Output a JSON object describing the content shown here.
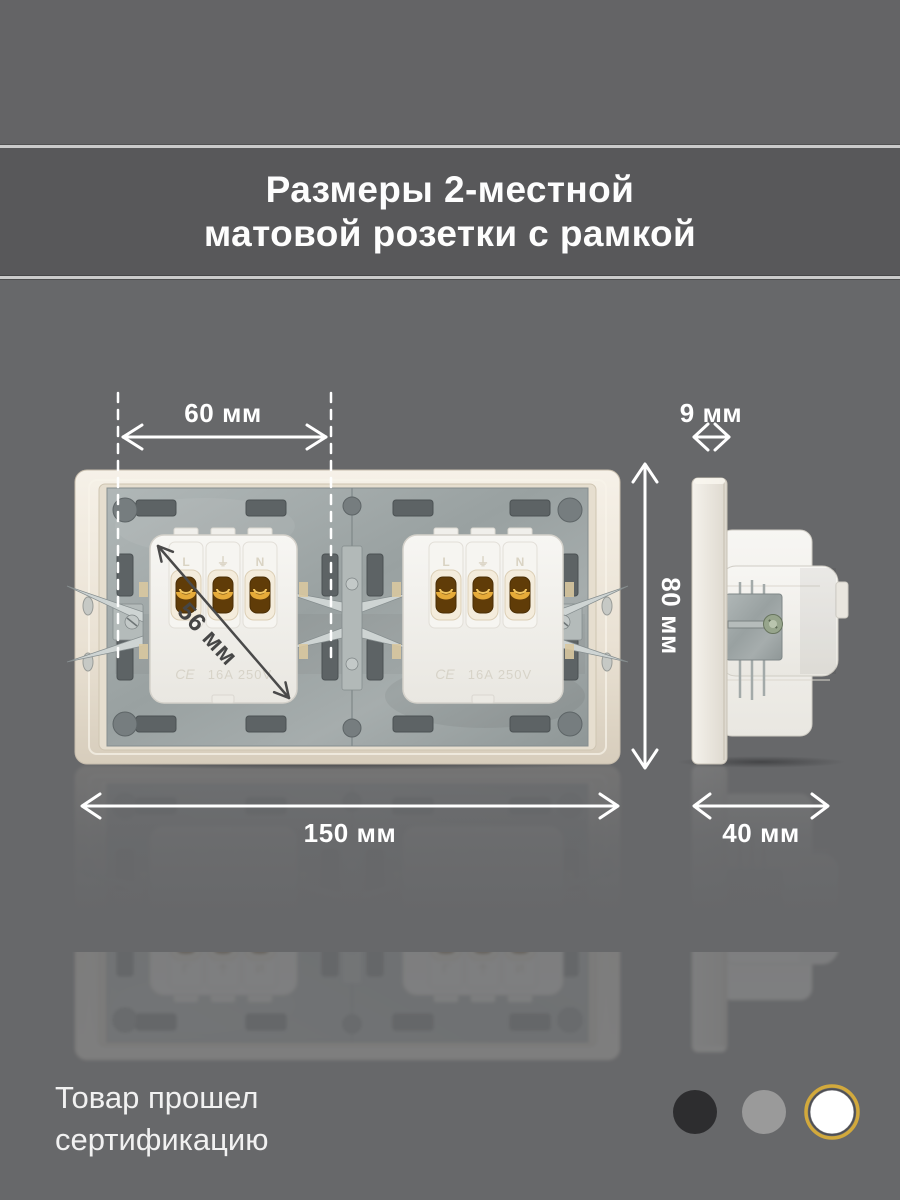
{
  "title": {
    "line1": "Размеры 2-местной",
    "line2": "матовой розетки с рамкой"
  },
  "annotations": {
    "center_spacing": "60 мм",
    "plate_thickness": "9 мм",
    "height": "80 мм",
    "mechanism_diagonal": "56 мм",
    "width": "150 мм",
    "depth": "40 мм"
  },
  "socket": {
    "terminals": [
      "L",
      "⏚",
      "N"
    ],
    "ce_mark": "CE",
    "rating": "16A 250V"
  },
  "certification": {
    "line1": "Товар прошел",
    "line2": "сертификацию"
  },
  "color_options": [
    {
      "name": "black",
      "hex": "#2d2d2f",
      "selected": false
    },
    {
      "name": "gray",
      "hex": "#9a9a9a",
      "selected": false
    },
    {
      "name": "white",
      "hex": "#ffffff",
      "ring": "#d2a93c",
      "selected": true
    }
  ],
  "palette": {
    "background": "#67686a",
    "top_strip": "#646466",
    "title_band": "#58585a",
    "separator": "#cbcbcb",
    "annotation_light": "#ffffff",
    "annotation_dark": "#464646",
    "frame_cream": "#e9e1d3",
    "metal": "#9aa2a2",
    "brass": "#e6ab39"
  }
}
